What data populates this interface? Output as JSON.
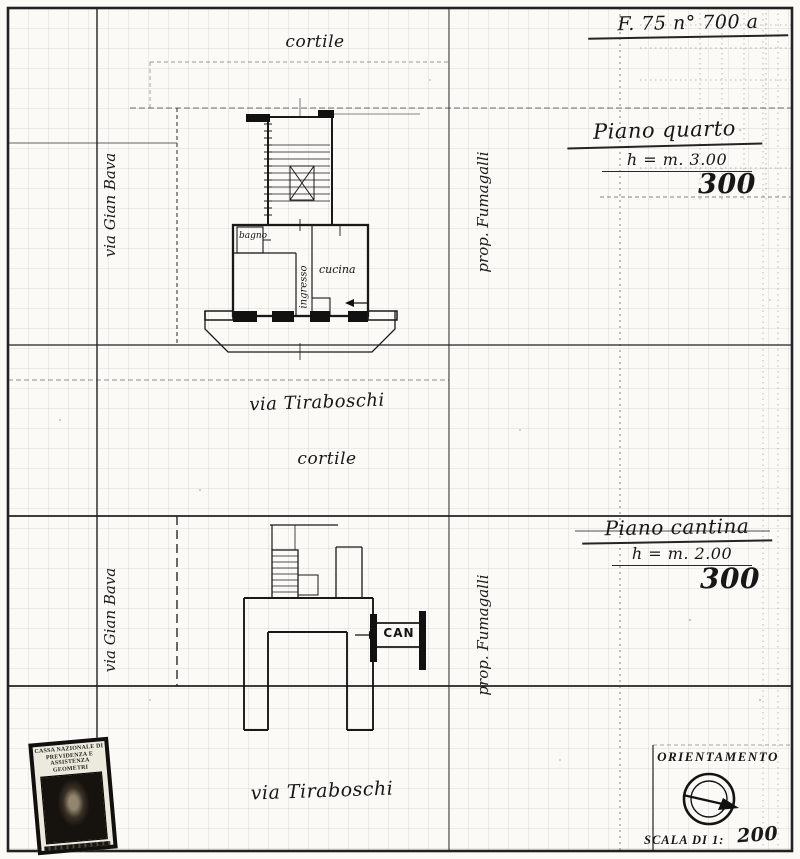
{
  "header": {
    "folio_ref": "F. 75   n° 700 a"
  },
  "upper_plan": {
    "title": "Piano quarto",
    "height_note": "h = m. 3.00",
    "scale_number": "300",
    "courtyard_top": "cortile",
    "street_left": "via Gian Bava",
    "owner_right": "prop. Fumagalli",
    "street_below": "via Tiraboschi",
    "courtyard_below": "cortile",
    "rooms": {
      "bath": "bagno",
      "hall": "ingresso",
      "kitchen": "cucina"
    }
  },
  "lower_plan": {
    "title": "Piano cantina",
    "height_note": "h = m. 2.00",
    "scale_number": "300",
    "street_left": "via Gian Bava",
    "owner_right": "prop. Fumagalli",
    "street_below": "via Tiraboschi",
    "cellar_label": "CAN"
  },
  "stamp": {
    "line1": "CASSA NAZIONALE DI",
    "line2": "PREVIDENZA E ASSISTENZA",
    "line3": "GEOMETRI"
  },
  "orientation": {
    "title": "ORIENTAMENTO",
    "scale_prefix": "SCALA DI 1:",
    "scale_value": "200"
  },
  "colors": {
    "ink": "#1c1c1c",
    "paper": "#fbfaf7",
    "grid": "#9a9a9a"
  }
}
